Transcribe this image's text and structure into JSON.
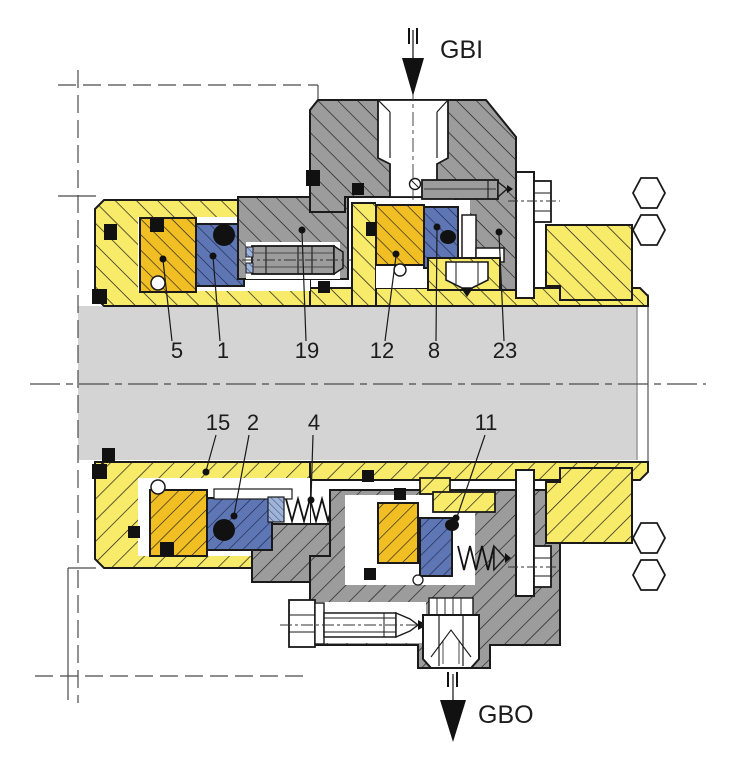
{
  "drawing": {
    "kind": "mechanical-seal-cross-section",
    "ports": {
      "inlet_label": "GBI",
      "outlet_label": "GBO"
    },
    "callouts_top": [
      {
        "label": "5"
      },
      {
        "label": "1"
      },
      {
        "label": "19"
      },
      {
        "label": "12"
      },
      {
        "label": "8"
      },
      {
        "label": "23"
      }
    ],
    "callouts_bottom": [
      {
        "label": "15"
      },
      {
        "label": "2"
      },
      {
        "label": "4"
      },
      {
        "label": "11"
      }
    ],
    "colors": {
      "sleeve_yellow": "#F7EB69",
      "seal_face_gold": "#F1BF24",
      "seal_ring_blue": "#5F76B4",
      "spring_retainer_blue": "#9FB4D8",
      "metal_gray": "#9C9C9C",
      "shaft_gray": "#D4D4D4",
      "outline": "#1A1A1A"
    }
  }
}
